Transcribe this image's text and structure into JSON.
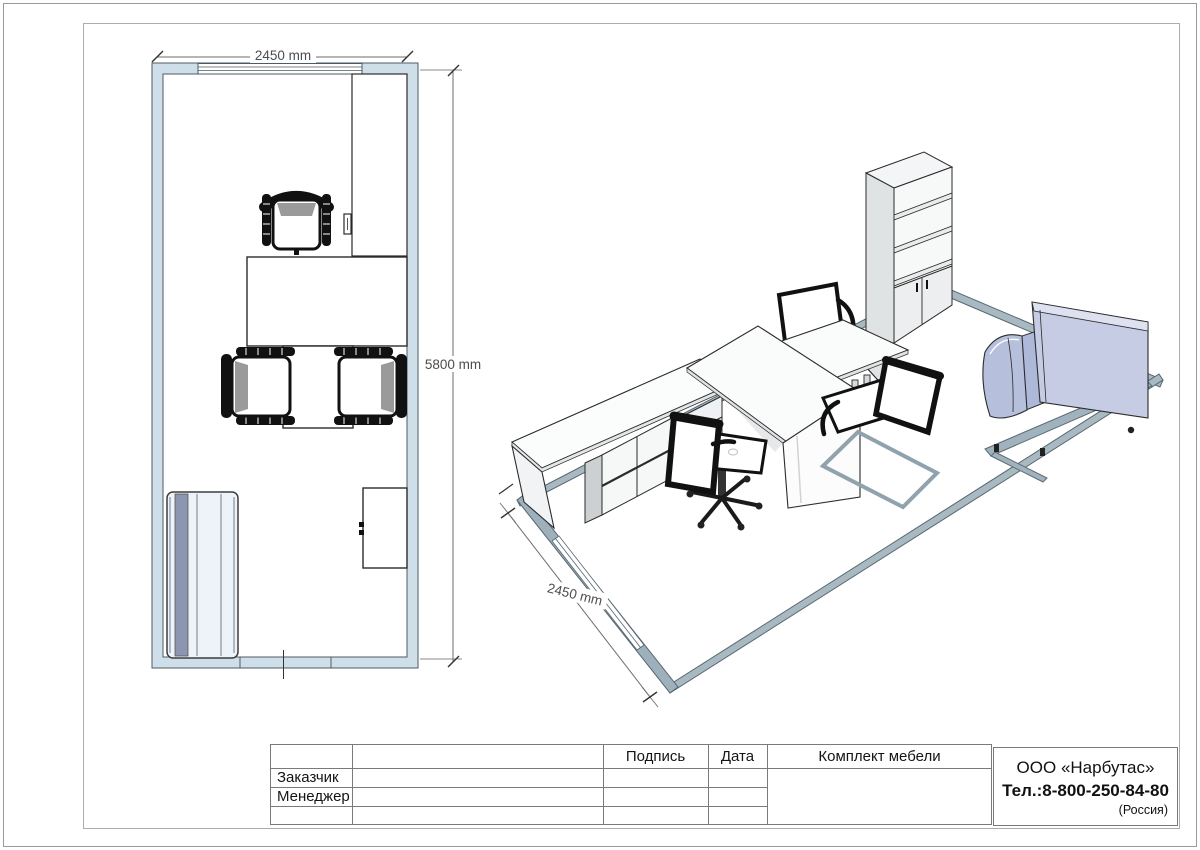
{
  "plan": {
    "width_dim": "2450 mm",
    "height_dim": "5800 mm"
  },
  "iso": {
    "front_dim": "2450 mm"
  },
  "title_block": {
    "headers": {
      "signature": "Подпись",
      "date": "Дата",
      "furniture_set": "Комплект мебели"
    },
    "rows": [
      {
        "label": "Заказчик"
      },
      {
        "label": "Менеджер"
      },
      {
        "label": ""
      }
    ],
    "company": {
      "name": "ООО «Нарбутас»",
      "phone": "Тел.:8-800-250-84-80",
      "country": "(Россия)"
    }
  },
  "colors": {
    "plan_wall_fill": "#cfdfe9",
    "iso_wall_band": "#a8b9c2",
    "sofa_body": "#b6bfdc",
    "sofa_back": "#c6cce4",
    "outline": "#2b2b2b",
    "dim_text": "#4d4d4d"
  }
}
